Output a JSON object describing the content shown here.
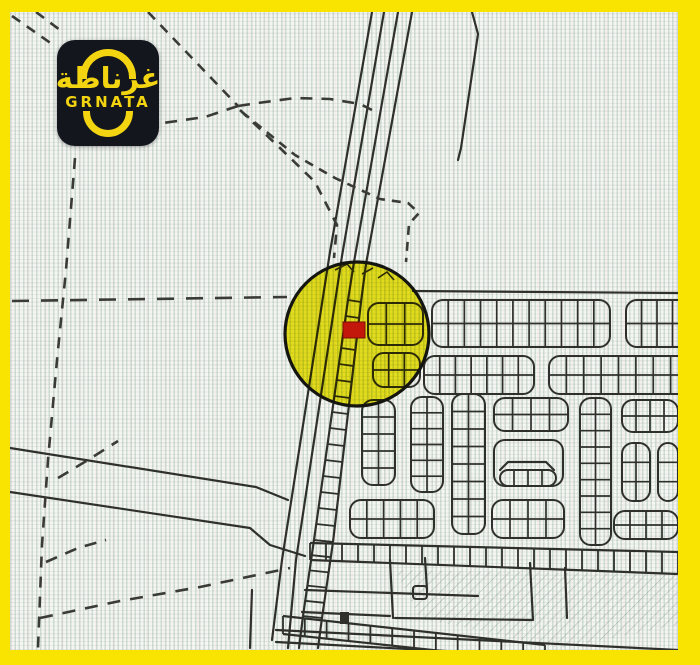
{
  "brand": {
    "logo_arabic": "غرناطة",
    "logo_latin": "GRNATA",
    "logo_bg": "#14161d",
    "logo_fg": "#f2d411"
  },
  "frame_color": "#f9e300",
  "map": {
    "ink": "#2f302c",
    "dash_ink": "#3a3b37",
    "highlight": {
      "cx": 347,
      "cy": 322,
      "r": 72,
      "fill": "#eadf00",
      "stroke": "#15150f",
      "marker": {
        "x": 333,
        "y": 310,
        "w": 22,
        "h": 16,
        "fill": "#c3170c"
      }
    },
    "solids": [
      [
        [
          362,
          0
        ],
        [
          320,
          240
        ],
        [
          272,
          548
        ],
        [
          262,
          628
        ]
      ],
      [
        [
          374,
          0
        ],
        [
          332,
          244
        ],
        [
          286,
          548
        ],
        [
          278,
          636
        ]
      ],
      [
        [
          388,
          0
        ],
        [
          344,
          250
        ],
        [
          338,
          288
        ]
      ],
      [
        [
          402,
          0
        ],
        [
          356,
          252
        ],
        [
          351,
          290
        ]
      ],
      [
        [
          462,
          0
        ],
        [
          468,
          22
        ],
        [
          451,
          136
        ],
        [
          448,
          148
        ]
      ],
      [
        [
          403,
          279
        ],
        [
          668,
          281
        ]
      ],
      [
        [
          0,
          436
        ],
        [
          246,
          475
        ],
        [
          278,
          488
        ]
      ],
      [
        [
          0,
          480
        ],
        [
          240,
          516
        ],
        [
          260,
          533
        ],
        [
          295,
          544
        ]
      ],
      [
        [
          555,
          556
        ],
        [
          557,
          606
        ]
      ],
      [
        [
          295,
          578
        ],
        [
          468,
          584
        ]
      ],
      [
        [
          292,
          600
        ],
        [
          380,
          604
        ]
      ],
      [
        [
          380,
          548
        ],
        [
          383,
          606
        ]
      ],
      [
        [
          520,
          551
        ],
        [
          523,
          608
        ]
      ],
      [
        [
          385,
          606
        ],
        [
          522,
          608
        ]
      ],
      [
        [
          415,
          546
        ],
        [
          417,
          578
        ]
      ],
      [
        [
          266,
          618
        ],
        [
          668,
          638
        ]
      ],
      [
        [
          266,
          630
        ],
        [
          530,
          644
        ]
      ],
      [
        [
          293,
          604
        ],
        [
          289,
          636
        ]
      ],
      [
        [
          312,
          606
        ],
        [
          308,
          636
        ]
      ],
      [
        [
          242,
          578
        ],
        [
          240,
          636
        ]
      ],
      [
        [
          490,
          458
        ],
        [
          498,
          450
        ],
        [
          536,
          450
        ],
        [
          544,
          458
        ]
      ]
    ],
    "strips": [
      {
        "x": 358,
        "y": 291,
        "w": 55,
        "h": 42,
        "rows": 2,
        "cols": 3
      },
      {
        "x": 422,
        "y": 288,
        "w": 178,
        "h": 47,
        "rows": 2,
        "cols": 11
      },
      {
        "x": 616,
        "y": 288,
        "w": 62,
        "h": 47,
        "rows": 2,
        "cols": 4
      },
      {
        "x": 363,
        "y": 341,
        "w": 47,
        "h": 34,
        "rows": 2,
        "cols": 3
      },
      {
        "x": 414,
        "y": 344,
        "w": 110,
        "h": 38,
        "rows": 2,
        "cols": 7
      },
      {
        "x": 539,
        "y": 344,
        "w": 139,
        "h": 38,
        "rows": 2,
        "cols": 8
      },
      {
        "x": 352,
        "y": 388,
        "w": 33,
        "h": 85,
        "rows": 5,
        "cols": 2
      },
      {
        "x": 340,
        "y": 488,
        "w": 84,
        "h": 38,
        "rows": 2,
        "cols": 5
      },
      {
        "x": 401,
        "y": 385,
        "w": 32,
        "h": 95,
        "rows": 6,
        "cols": 2
      },
      {
        "x": 442,
        "y": 382,
        "w": 33,
        "h": 140,
        "rows": 8,
        "cols": 2
      },
      {
        "x": 484,
        "y": 386,
        "w": 74,
        "h": 33,
        "rows": 2,
        "cols": 4
      },
      {
        "x": 484,
        "y": 428,
        "w": 69,
        "h": 46,
        "rows": 1,
        "cols": 1
      },
      {
        "x": 490,
        "y": 458,
        "w": 56,
        "h": 16,
        "rows": 1,
        "cols": 4
      },
      {
        "x": 482,
        "y": 488,
        "w": 72,
        "h": 38,
        "rows": 2,
        "cols": 4
      },
      {
        "x": 570,
        "y": 386,
        "w": 31,
        "h": 147,
        "rows": 9,
        "cols": 2
      },
      {
        "x": 612,
        "y": 388,
        "w": 56,
        "h": 32,
        "rows": 2,
        "cols": 4
      },
      {
        "x": 612,
        "y": 431,
        "w": 28,
        "h": 58,
        "rows": 3,
        "cols": 2
      },
      {
        "x": 648,
        "y": 431,
        "w": 20,
        "h": 58,
        "rows": 3,
        "cols": 1
      },
      {
        "x": 604,
        "y": 499,
        "w": 64,
        "h": 28,
        "rows": 2,
        "cols": 4
      }
    ],
    "ladders": [
      {
        "r1": [
          338,
          288,
          304,
          528
        ],
        "r2": [
          351,
          290,
          323,
          530
        ],
        "n": 15
      },
      {
        "r1": [
          304,
          528,
          293,
          604
        ],
        "r2": [
          323,
          530,
          312,
          606
        ],
        "n": 5
      },
      {
        "r1": [
          300,
          531,
          668,
          540
        ],
        "r2": [
          300,
          548,
          668,
          562
        ],
        "n": 23
      },
      {
        "r1": [
          273,
          604,
          535,
          633
        ],
        "r2": [
          273,
          622,
          535,
          650
        ],
        "n": 12
      }
    ],
    "dashes": [
      {
        "pts": [
          [
            65,
            146
          ],
          [
            56,
            258
          ],
          [
            47,
            348
          ],
          [
            38,
            448
          ],
          [
            32,
            533
          ],
          [
            28,
            636
          ]
        ],
        "dash": "11 9"
      },
      {
        "pts": [
          [
            2,
            289
          ],
          [
            277,
            285
          ]
        ],
        "dash": "17 12"
      },
      {
        "pts": [
          [
            2,
            4
          ],
          [
            42,
            32
          ]
        ],
        "dash": "10 8"
      },
      {
        "pts": [
          [
            26,
            0
          ],
          [
            50,
            18
          ]
        ],
        "dash": "10 8"
      },
      {
        "pts": [
          [
            138,
            0
          ],
          [
            228,
            94
          ]
        ],
        "dash": "10 8"
      },
      {
        "pts": [
          [
            228,
            94
          ],
          [
            248,
            91
          ],
          [
            285,
            86
          ],
          [
            320,
            87
          ],
          [
            350,
            92
          ],
          [
            362,
            98
          ]
        ],
        "dash": "12 9"
      },
      {
        "pts": [
          [
            228,
            94
          ],
          [
            195,
            105
          ],
          [
            153,
            111
          ]
        ],
        "dash": "12 9"
      },
      {
        "pts": [
          [
            230,
            98
          ],
          [
            270,
            136
          ],
          [
            305,
            170
          ],
          [
            327,
            213
          ],
          [
            324,
            246
          ]
        ],
        "dash": "10 8"
      },
      {
        "pts": [
          [
            232,
            100
          ],
          [
            285,
            143
          ],
          [
            325,
            166
          ],
          [
            370,
            187
          ],
          [
            398,
            191
          ],
          [
            409,
            201
          ],
          [
            399,
            212
          ],
          [
            396,
            250
          ]
        ],
        "dash": "9 7"
      },
      {
        "pts": [
          [
            48,
            466
          ],
          [
            78,
            448
          ],
          [
            108,
            429
          ]
        ],
        "dash": "12 9"
      },
      {
        "pts": [
          [
            36,
            550
          ],
          [
            68,
            536
          ],
          [
            96,
            528
          ]
        ],
        "dash": "12 9"
      },
      {
        "pts": [
          [
            30,
            606
          ],
          [
            110,
            589
          ],
          [
            190,
            575
          ],
          [
            280,
            556
          ]
        ],
        "dash": "13 10"
      }
    ],
    "squares": [
      {
        "x": 403,
        "y": 574,
        "w": 14,
        "h": 13
      }
    ],
    "blobs": [
      {
        "x": 330,
        "y": 600,
        "w": 9,
        "h": 12
      }
    ],
    "scribbles": [
      [
        [
          325,
          258
        ],
        [
          337,
          252
        ],
        [
          344,
          260
        ]
      ],
      [
        [
          352,
          262
        ],
        [
          363,
          256
        ]
      ],
      [
        [
          368,
          266
        ],
        [
          377,
          260
        ],
        [
          384,
          268
        ]
      ]
    ],
    "hatch_points": "385,558 668,563 668,613 550,636 410,606"
  }
}
